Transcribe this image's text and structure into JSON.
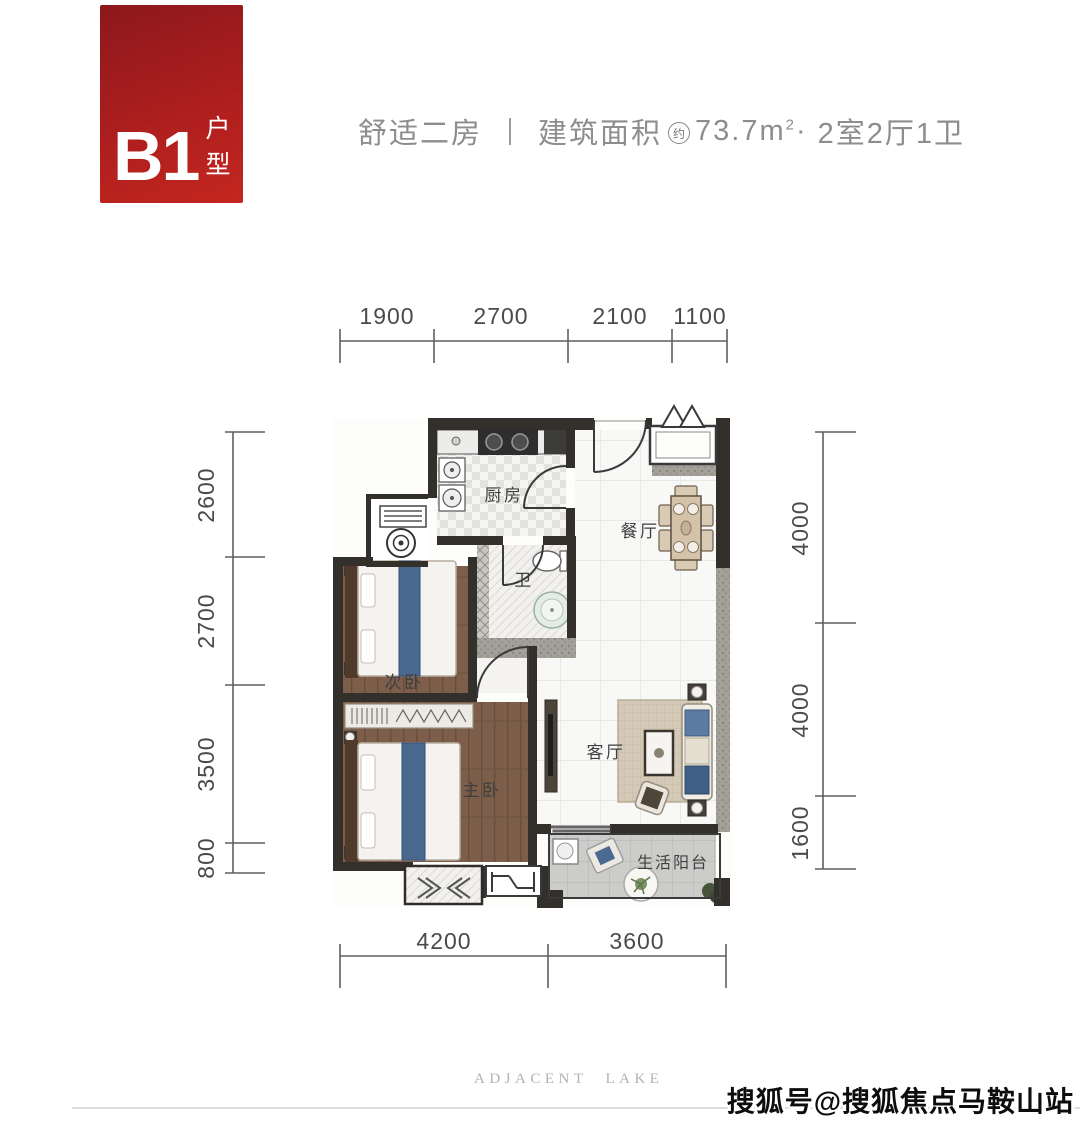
{
  "badge": {
    "code": "B1",
    "label": "户型"
  },
  "header": {
    "title": "舒适二房",
    "area_label": "建筑面积",
    "area_approx": "约",
    "area_value": "73.7m",
    "area_sup": "2",
    "dot": "·",
    "layout": "2室2厅1卫"
  },
  "rooms": {
    "kitchen": "厨房",
    "bath": "卫",
    "dining": "餐厅",
    "bedroom2": "次卧",
    "master": "主卧",
    "living": "客厅",
    "balcony": "生活阳台"
  },
  "dimensions": {
    "top": [
      "1900",
      "2700",
      "2100",
      "1100"
    ],
    "bottom": [
      "4200",
      "3600"
    ],
    "left": [
      "2600",
      "2700",
      "3500",
      "800"
    ],
    "right": [
      "4000",
      "4000",
      "1600"
    ]
  },
  "footer": {
    "brand": "ADJACENT LAKE",
    "watermark": "搜狐号@搜狐焦点马鞍山站"
  }
}
